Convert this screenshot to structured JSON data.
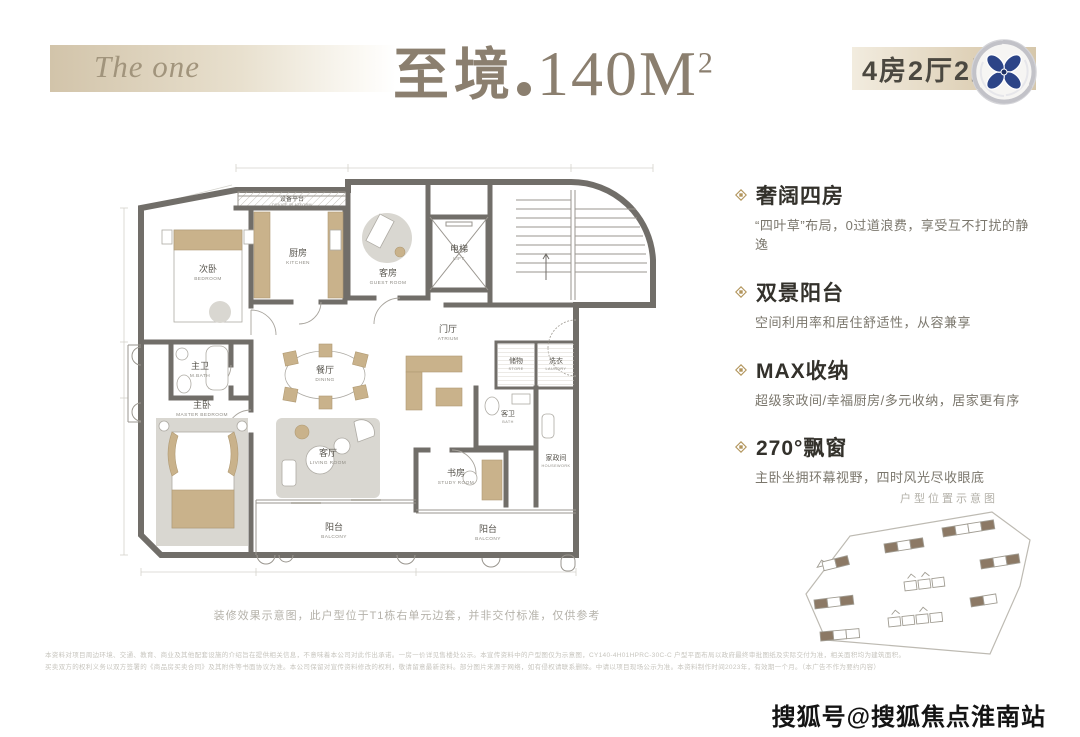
{
  "header": {
    "brand": "The one",
    "title_cn": "至境",
    "title_area": "140M",
    "title_sup": "2",
    "spec_badge": "4房2厅2卫"
  },
  "features": [
    {
      "title": "奢阔四房",
      "desc": "“四叶草”布局，0过道浪费，享受互不打扰的静逸"
    },
    {
      "title": "双景阳台",
      "desc": "空间利用率和居住舒适性，从容兼享"
    },
    {
      "title": "MAX收纳",
      "desc": "超级家政间/幸福厨房/多元收纳，居家更有序"
    },
    {
      "title": "270°飘窗",
      "desc": "主卧坐拥环幕视野，四时风光尽收眼底"
    }
  ],
  "plan": {
    "note": "装修效果示意图，此户型位于T1栋右单元边套，并非交付标准，仅供参考",
    "rooms": [
      {
        "cn": "设备平台",
        "en": "DEVICE PLATFORM"
      },
      {
        "cn": "次卧",
        "en": "BEDROOM"
      },
      {
        "cn": "厨房",
        "en": "KITCHEN"
      },
      {
        "cn": "客房",
        "en": "GUEST ROOM"
      },
      {
        "cn": "电梯",
        "en": "LIFT"
      },
      {
        "cn": "门厅",
        "en": "ATRIUM"
      },
      {
        "cn": "储物",
        "en": "STORE"
      },
      {
        "cn": "洗衣",
        "en": "LAUNDRY"
      },
      {
        "cn": "餐厅",
        "en": "DINING"
      },
      {
        "cn": "主卫",
        "en": "M.BATH"
      },
      {
        "cn": "主卧",
        "en": "MASTER BEDROOM"
      },
      {
        "cn": "客厅",
        "en": "LIVING ROOM"
      },
      {
        "cn": "阳台",
        "en": "BALCONY"
      },
      {
        "cn": "书房",
        "en": "STUDY ROOM"
      },
      {
        "cn": "阳台",
        "en": "BALCONY"
      },
      {
        "cn": "客卫",
        "en": "BATH"
      },
      {
        "cn": "家政间",
        "en": "HOUSEWORK"
      }
    ]
  },
  "siteplan": {
    "caption": "户型位置示意图"
  },
  "footer": {
    "disclaimer_line1": "本资料对项目周边环境、交通、教育、商业及其他配套设施的介绍旨在提供相关信息，不意味着本公司对此作出承诺。一房一价详见售楼处公示。本宣传资料中的户型图仅为示意图，CY140-4H01HPRC-30C-C 户型平面布局以政府最终审批图纸及实际交付为准，相关面积均为建筑面积。",
    "disclaimer_line2": "买卖双方的权利义务以双方签署的《商品房买卖合同》及其附件等书面协议为准。本公司保留对宣传资料修改的权利，敬请留意最新资料。部分图片来源于网络，如有侵权请联系删除。中请以项目现场公示为准。本资料制作时间2023年，有效期一个月。（本广告不作为要约内容）",
    "watermark": "搜狐号@搜狐焦点淮南站"
  },
  "colors": {
    "accent_gold": "#b2955c",
    "banner_beige": "#d6c7ab",
    "title_taupe": "#8b7f6f",
    "wall_gray": "#716e69",
    "site_brown": "#8c7965",
    "logo_navy": "#2c4487"
  }
}
